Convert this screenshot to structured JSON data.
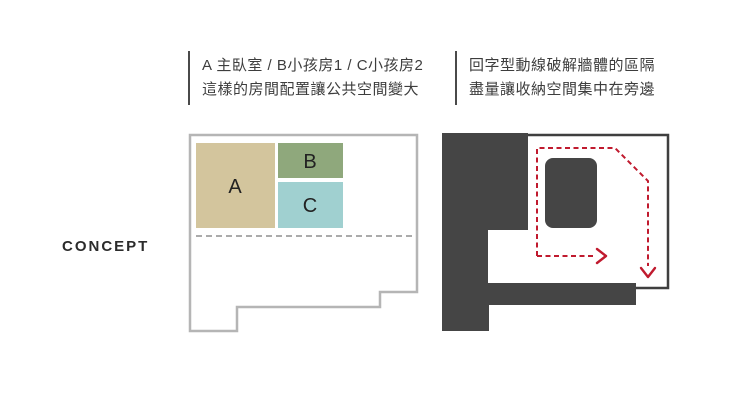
{
  "concept": {
    "label": "CONCEPT"
  },
  "notes": {
    "left": {
      "line1": "A 主臥室 / B小孩房1 / C小孩房2",
      "line2": "這樣的房間配置讓公共空間變大"
    },
    "right": {
      "line1": "回字型動線破解牆體的區隔",
      "line2": "盡量讓收納空間集中在旁邊"
    }
  },
  "left_plan": {
    "outline_color": "#b5b5b5",
    "divider_color": "#8f8f8f",
    "rooms": [
      {
        "label": "A",
        "color": "#d3c59d"
      },
      {
        "label": "B",
        "color": "#8fa87c"
      },
      {
        "label": "C",
        "color": "#a0d0d0"
      }
    ]
  },
  "right_plan": {
    "wall_color": "#454545",
    "border_color": "#3f3f3f",
    "circulation_color": "#c01a2e"
  }
}
